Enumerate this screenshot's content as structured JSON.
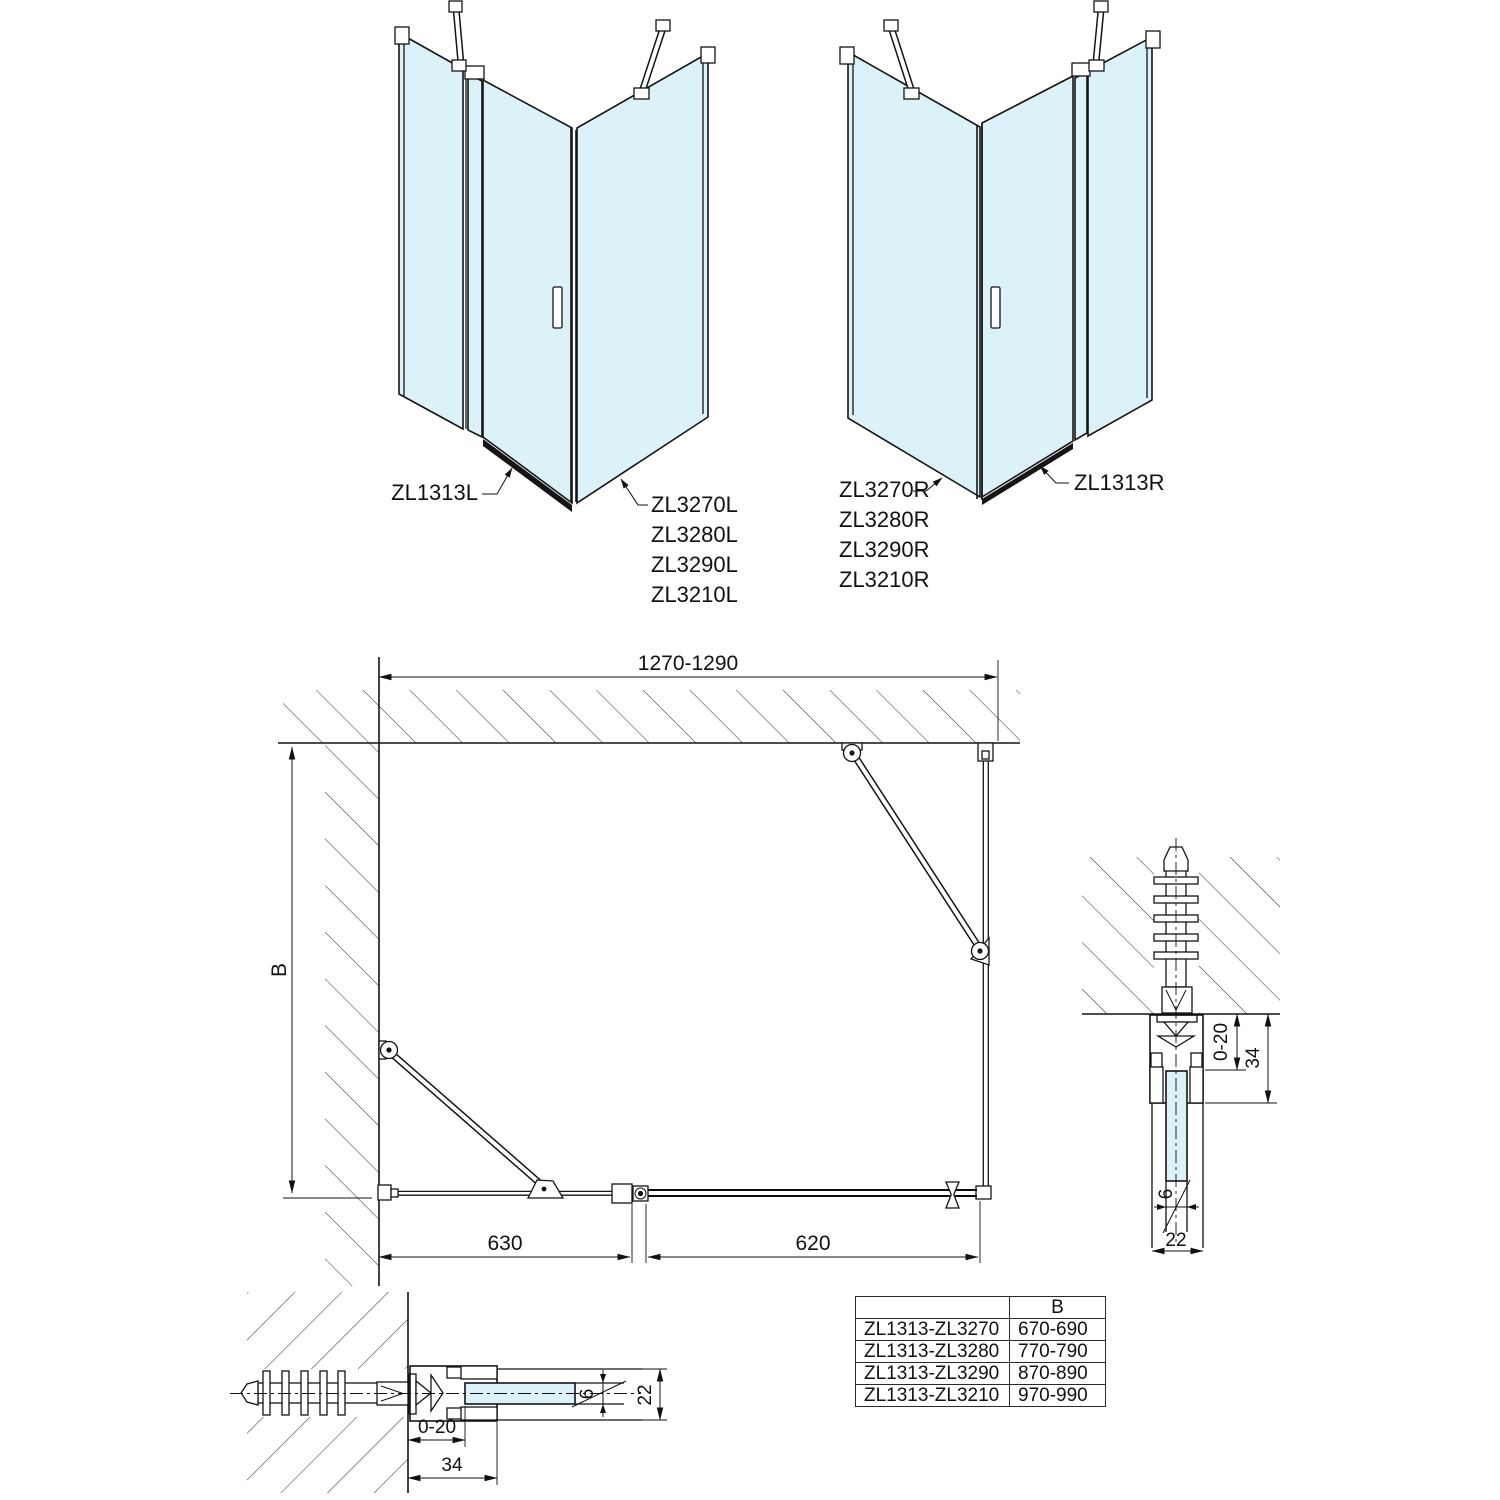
{
  "colors": {
    "glass": "#dcf2f9",
    "line": "#141414"
  },
  "left_view": {
    "wall_panel_label": "ZL1313L",
    "door_labels": [
      "ZL3270L",
      "ZL3280L",
      "ZL3290L",
      "ZL3210L"
    ]
  },
  "right_view": {
    "door_labels": [
      "ZL3270R",
      "ZL3280R",
      "ZL3290R",
      "ZL3210R"
    ],
    "wall_panel_label": "ZL1313R"
  },
  "plan": {
    "width_dim": "1270-1290",
    "depth_dim": "B",
    "fixed_panel_dim": "630",
    "door_dim": "620"
  },
  "detail_side": {
    "adjust_dim": "0-20",
    "profile_dim": "34",
    "glass_dim": "6",
    "frame_dim": "22"
  },
  "detail_bottom": {
    "adjust_dim": "0-20",
    "profile_dim": "34",
    "glass_dim": "6",
    "frame_dim": "22"
  },
  "size_table": {
    "model_header": "",
    "b_header": "B",
    "rows": [
      {
        "model": "ZL1313-ZL3270",
        "b": "670-690"
      },
      {
        "model": "ZL1313-ZL3280",
        "b": "770-790"
      },
      {
        "model": "ZL1313-ZL3290",
        "b": "870-890"
      },
      {
        "model": "ZL1313-ZL3210",
        "b": "970-990"
      }
    ]
  }
}
